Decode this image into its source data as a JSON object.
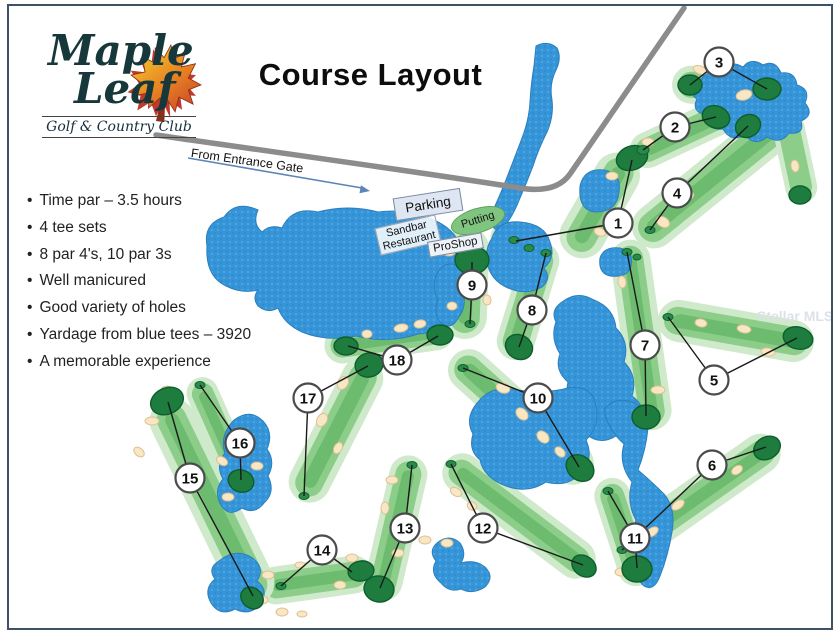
{
  "title": "Course Layout",
  "logo": {
    "line1": "Maple",
    "line2": "Leaf",
    "subtitle": "Golf & Country Club"
  },
  "entrance_label": "From Entrance Gate",
  "facilities": {
    "parking": "Parking",
    "putting": "Putting",
    "sandbar_line1": "Sandbar",
    "sandbar_line2": "Restaurant",
    "proshop": "ProShop"
  },
  "bullets": [
    "Time par – 3.5 hours",
    "4 tee sets",
    "8 par 4's, 10 par 3s",
    "Well manicured",
    "Good variety of holes",
    "Yardage from blue tees – 3920",
    "A memorable experience"
  ],
  "watermark": "Stellar MLS",
  "holes": [
    {
      "n": 1,
      "x": 618,
      "y": 223,
      "green": [
        632,
        160
      ],
      "tee": [
        516,
        241
      ]
    },
    {
      "n": 2,
      "x": 675,
      "y": 127,
      "green": [
        716,
        117
      ],
      "tee": [
        643,
        150
      ]
    },
    {
      "n": 3,
      "x": 719,
      "y": 62,
      "green": [
        767,
        89
      ],
      "tee": [
        690,
        85
      ]
    },
    {
      "n": 4,
      "x": 677,
      "y": 193,
      "green": [
        748,
        126
      ],
      "tee": [
        650,
        230
      ]
    },
    {
      "n": 5,
      "x": 714,
      "y": 380,
      "green": [
        797,
        338
      ],
      "tee": [
        668,
        317
      ]
    },
    {
      "n": 6,
      "x": 712,
      "y": 465,
      "green": [
        766,
        447
      ],
      "tee": [
        622,
        550
      ]
    },
    {
      "n": 7,
      "x": 645,
      "y": 345,
      "green": [
        646,
        416
      ],
      "tee": [
        627,
        252
      ]
    },
    {
      "n": 8,
      "x": 532,
      "y": 310,
      "green": [
        519,
        347
      ],
      "tee": [
        546,
        253
      ]
    },
    {
      "n": 9,
      "x": 472,
      "y": 285,
      "green": [
        472,
        262
      ],
      "tee": [
        470,
        324
      ]
    },
    {
      "n": 10,
      "x": 538,
      "y": 398,
      "green": [
        579,
        467
      ],
      "tee": [
        463,
        368
      ]
    },
    {
      "n": 11,
      "x": 635,
      "y": 538,
      "green": [
        637,
        568
      ],
      "tee": [
        608,
        491
      ]
    },
    {
      "n": 12,
      "x": 483,
      "y": 528,
      "green": [
        583,
        565
      ],
      "tee": [
        451,
        464
      ]
    },
    {
      "n": 13,
      "x": 405,
      "y": 528,
      "green": [
        380,
        588
      ],
      "tee": [
        412,
        465
      ]
    },
    {
      "n": 14,
      "x": 322,
      "y": 550,
      "green": [
        352,
        572
      ],
      "tee": [
        281,
        586
      ]
    },
    {
      "n": 15,
      "x": 190,
      "y": 478,
      "green": [
        168,
        402
      ],
      "tee": [
        253,
        596
      ]
    },
    {
      "n": 16,
      "x": 240,
      "y": 443,
      "green": [
        241,
        480
      ],
      "tee": [
        200,
        385
      ]
    },
    {
      "n": 17,
      "x": 308,
      "y": 398,
      "green": [
        368,
        366
      ],
      "tee": [
        304,
        496
      ]
    },
    {
      "n": 18,
      "x": 397,
      "y": 360,
      "green": [
        438,
        336
      ],
      "tee": [
        348,
        346
      ]
    }
  ],
  "colors": {
    "water": "#3595d8",
    "fairway_light": "#cfe9cb",
    "fairway_mid": "#8ccd8a",
    "green_dark": "#1d7c3e",
    "bunker": "#f8e7c4",
    "road": "#8c8c8c",
    "frame": "#3e5166",
    "arrow": "#5c84b5",
    "putting_fill": "#7fc47f",
    "label_box": "#dde6f2",
    "watermark_gray": "#dce1e8"
  }
}
